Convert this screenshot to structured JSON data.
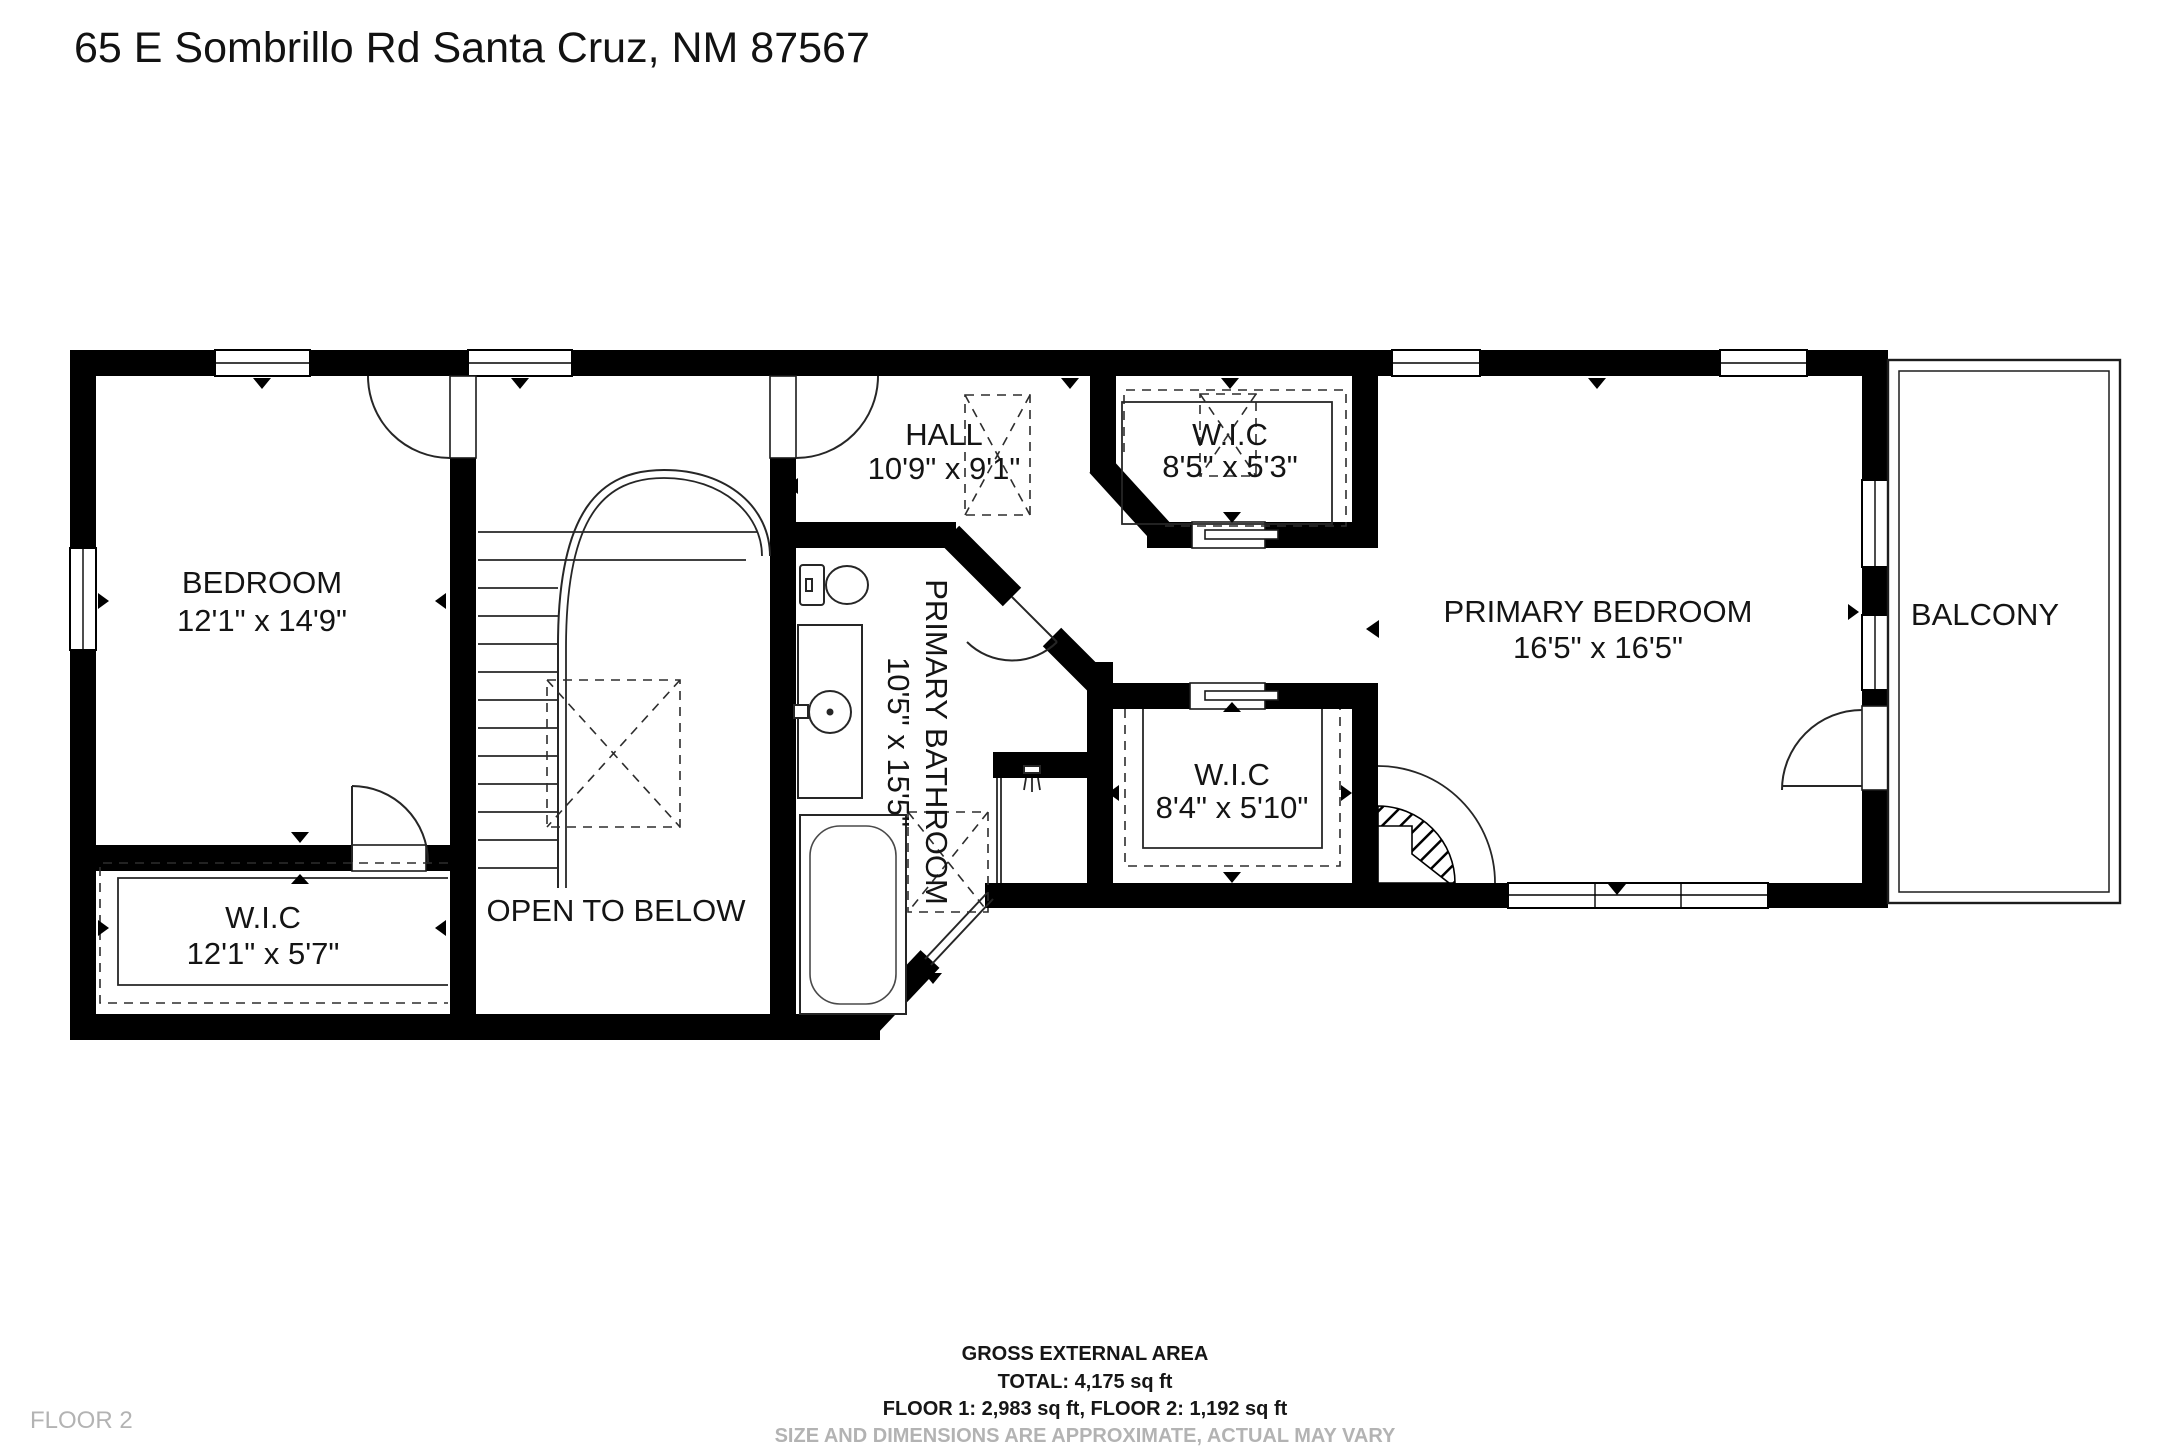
{
  "title": "65 E Sombrillo Rd Santa Cruz, NM 87567",
  "floor_label": "FLOOR 2",
  "rooms": {
    "bedroom": {
      "name": "BEDROOM",
      "dims": "12'1\" x 14'9\""
    },
    "wic_lower_left": {
      "name": "W.I.C",
      "dims": "12'1\" x 5'7\""
    },
    "open_to_below": {
      "name": "OPEN TO BELOW"
    },
    "hall": {
      "name": "HALL",
      "dims": "10'9\" x 9'1\""
    },
    "primary_bathroom": {
      "name": "PRIMARY BATHROOM",
      "dims": "10'5\" x 15'5\""
    },
    "wic_top": {
      "name": "W.I.C",
      "dims": "8'5\" x 5'3\""
    },
    "wic_middle": {
      "name": "W.I.C",
      "dims": "8'4\" x 5'10\""
    },
    "primary_bedroom": {
      "name": "PRIMARY BEDROOM",
      "dims": "16'5\" x 16'5\""
    },
    "balcony": {
      "name": "BALCONY"
    }
  },
  "footer": {
    "line1": "GROSS EXTERNAL AREA",
    "line2": "TOTAL: 4,175 sq ft",
    "line3": "FLOOR 1: 2,983 sq ft, FLOOR 2: 1,192 sq ft",
    "line4": "SIZE AND DIMENSIONS ARE APPROXIMATE, ACTUAL MAY VARY"
  },
  "colors": {
    "wall": "#000000",
    "background": "#ffffff",
    "muted": "#b3b3b3"
  }
}
